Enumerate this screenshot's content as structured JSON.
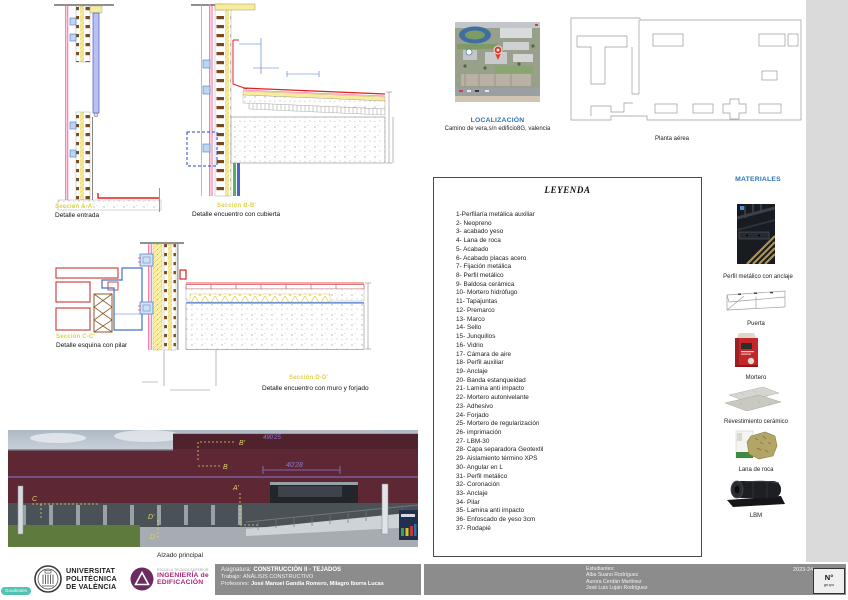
{
  "localization": {
    "title": "LOCALIZACIÓN",
    "address": "Camino de vera,s/n edificio8G, valencia"
  },
  "floor_plan": {
    "caption": "Planta aérea"
  },
  "details": [
    {
      "section": "Sección A-A'",
      "caption": "Detalle entrada"
    },
    {
      "section": "Sección B-B'",
      "caption": "Detalle encuentro con cubierta"
    },
    {
      "section": "Sección C-C'",
      "caption": "Detalle esquina con pilar"
    },
    {
      "section": "Sección D-D'",
      "caption": "Detalle encuentro con muro y forjado"
    }
  ],
  "elevation": {
    "caption": "Alzado principal",
    "dimension": "40'28",
    "dimension_top": "490'25",
    "markers": [
      "B'",
      "B",
      "A'",
      "C",
      "D'",
      "D"
    ]
  },
  "legend": {
    "title": "LEYENDA",
    "items": [
      "1-Perfilaría metálica auxiliar",
      "2- Neopreno",
      "3- acabado yeso",
      "4- Lana de roca",
      "5- Acabado",
      "6- Acabado placas acero",
      "7- Fijación metálica",
      "8- Perfil metálico",
      "9- Baldosa cerámica",
      "10- Mortero hidrófugo",
      "11- Tapajuntas",
      "12- Premarco",
      "13- Marco",
      "14- Sello",
      "15- Junquillos",
      "16- Vidrio",
      "17- Cámara de aire",
      "18- Perfil auxiliar",
      "19- Anclaje",
      "20- Banda estanqueidad",
      "21- Lamina anti impacto",
      "22- Mortero autonivelante",
      "23- Adhesivo",
      "24- Forjado",
      "25- Mortero de regularización",
      "26- imprimación",
      "27- LBM-30",
      "28- Capa separadora Geotextil",
      "29- Aislamiento término XPS",
      "30- Angular en L",
      "31- Perfil metálico",
      "32- Coronación",
      "33- Anclaje",
      "34- Pilar",
      "35- Lamina anti impacto",
      "36- Enfoscado de yeso 3cm",
      "37- Rodapié"
    ]
  },
  "materials": {
    "title": "MATERIALES",
    "items": [
      {
        "name": "Perfil metálico con anclaje"
      },
      {
        "name": "Puerta"
      },
      {
        "name": "Mortero"
      },
      {
        "name": "Revestimiento cerámico"
      },
      {
        "name": "Lana de roca"
      },
      {
        "name": "LBM"
      }
    ]
  },
  "title_block": {
    "university_lines": [
      "UNIVERSITAT",
      "POLITÈCNICA",
      "DE VALÈNCIA"
    ],
    "school_small": "ESCUELA TÉCNICA SUPERIOR",
    "school_lines": [
      "INGENIERÍA de",
      "EDIFICACIÓN"
    ],
    "subject_label": "Asignatura:",
    "subject": "CONSTRUCCIÓN II - TEJADOS",
    "work_label": "Trabajo:",
    "work": "ANÁLISIS CONSTRUCTIVO",
    "professors_label": "Profesores:",
    "professors": "José Manuel Gandía Romero, Milagro Iborra Lucas",
    "students_label": "Estudiantes:",
    "students": [
      "Alba Suano Rodríguez",
      "Aurora Cerdán Martínez",
      "José Luis Luján Rodríguez"
    ],
    "year": "2023-24",
    "sheet_no_label": "N°",
    "sheet_no_sub": "grupo"
  },
  "watermark": "Goodnotes",
  "colors": {
    "accent_blue": "#2e74b5",
    "label_yellow": "#ddd04e",
    "titleblock_gray": "#8c8c8c",
    "brand_magenta": "#b0257f",
    "watermark_teal": "#35b8a8",
    "detail_red": "#e02020",
    "detail_pink": "#ff7fb5",
    "facade_maroon": "#5e2734"
  }
}
